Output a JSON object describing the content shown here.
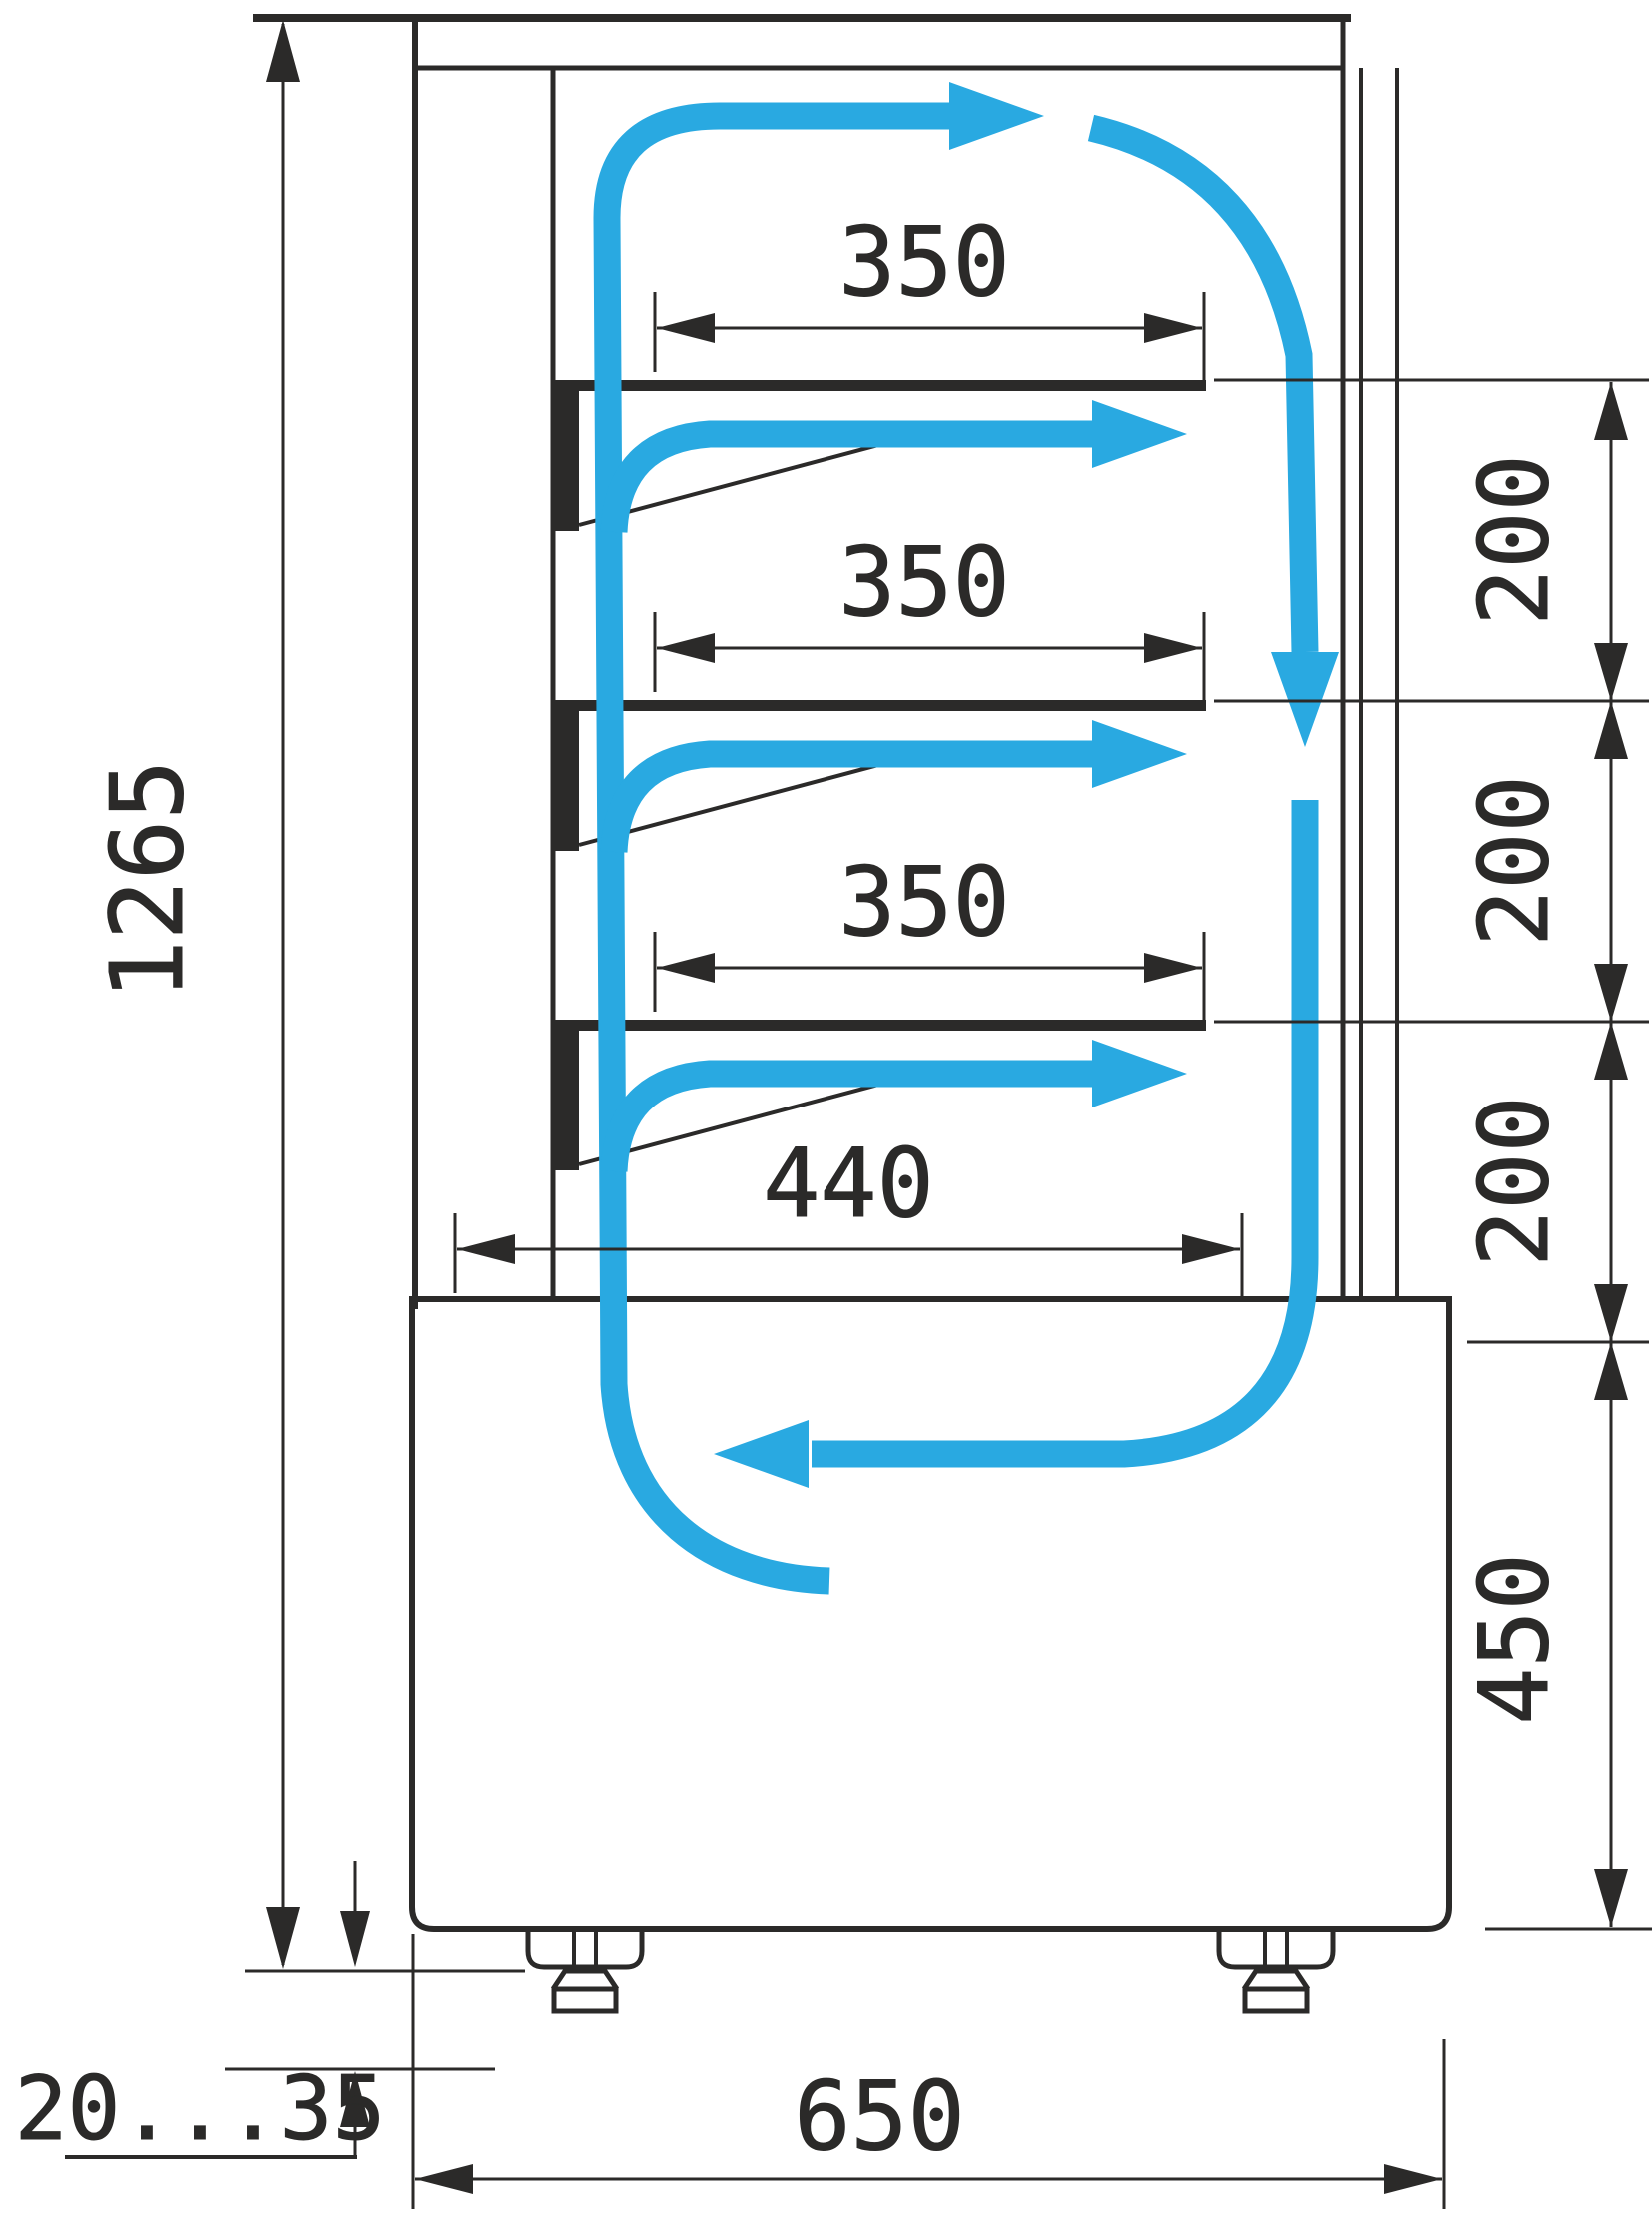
{
  "diagram": {
    "type": "technical-drawing",
    "subject": "refrigerated-display-case-side-section-with-airflow",
    "colors": {
      "line": "#2b2a29",
      "airflow": "#29a9e1",
      "background": "#ffffff"
    },
    "dimensions": {
      "overall_height": "1265",
      "shelf_depths": [
        "350",
        "350",
        "350"
      ],
      "bottom_shelf_depth": "440",
      "shelf_spacings": [
        "200",
        "200",
        "200"
      ],
      "base_height": "450",
      "overall_depth": "650",
      "foot_adjustment_range": "20...35"
    }
  }
}
